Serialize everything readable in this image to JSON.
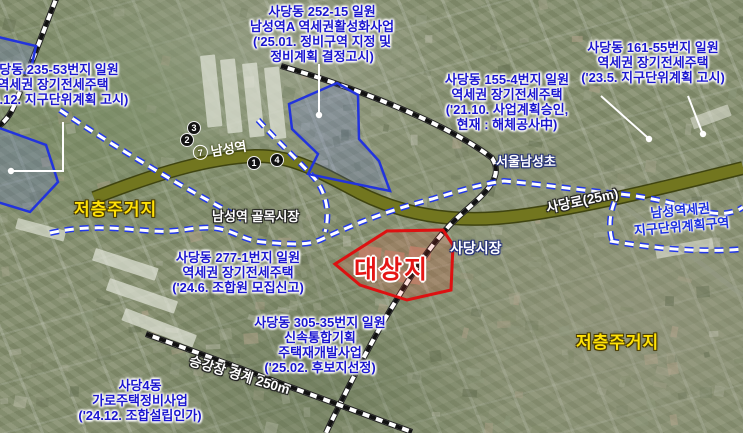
{
  "info_boxes": [
    {
      "id": "235-53",
      "lines": [
        "사당동 235-53번지 일원",
        "역세권 장기전세주택",
        "('24.12. 지구단위계획 고시)"
      ]
    },
    {
      "id": "252-15",
      "lines": [
        "사당동 252-15 일원",
        "남성역A 역세권활성화사업",
        "('25.01. 정비구역 지정 및",
        "정비계획 결정고시)"
      ]
    },
    {
      "id": "161-55",
      "lines": [
        "사당동 161-55번지 일원",
        "역세권 장기전세주택",
        "('23.5. 지구단위계획 고시)"
      ]
    },
    {
      "id": "155-4",
      "lines": [
        "사당동 155-4번지 일원",
        "역세권 장기전세주택",
        "('21.10. 사업계획승인,",
        "현재 : 해체공사中)"
      ]
    },
    {
      "id": "277-1",
      "lines": [
        "사당동 277-1번지 일원",
        "역세권 장기전세주택",
        "('24.6. 조합원 모집신고)"
      ]
    },
    {
      "id": "305-35",
      "lines": [
        "사당동 305-35번지 일원",
        "신속통합기획",
        "주택재개발사업",
        "('25.02. 후보지선정)"
      ]
    },
    {
      "id": "sadang4",
      "lines": [
        "사당4동",
        "가로주택정비사업",
        "('24.12. 조합설립인가)"
      ]
    }
  ],
  "labels": {
    "target_site": "대상지",
    "low_rise_west": "저층주거지",
    "low_rise_east": "저층주거지",
    "school": "서울남성초",
    "alley_market": "남성역 골목시장",
    "sadang_market": "사당시장",
    "road": "사당로(25m)",
    "platform_boundary": "승강장 경계 250m",
    "district_line1": "남성역세권",
    "district_line2": "지구단위계획구역"
  },
  "station": {
    "line_number": "7",
    "name": "남성역",
    "exits": [
      "3",
      "2",
      "1",
      "4"
    ]
  },
  "colors": {
    "info_text_blue": "#1a15cf",
    "target_red": "#e01111",
    "low_rise_yellow": "#ffe207",
    "zone_boundary_blue": "#2338e8",
    "road_olive": "#72761f"
  }
}
